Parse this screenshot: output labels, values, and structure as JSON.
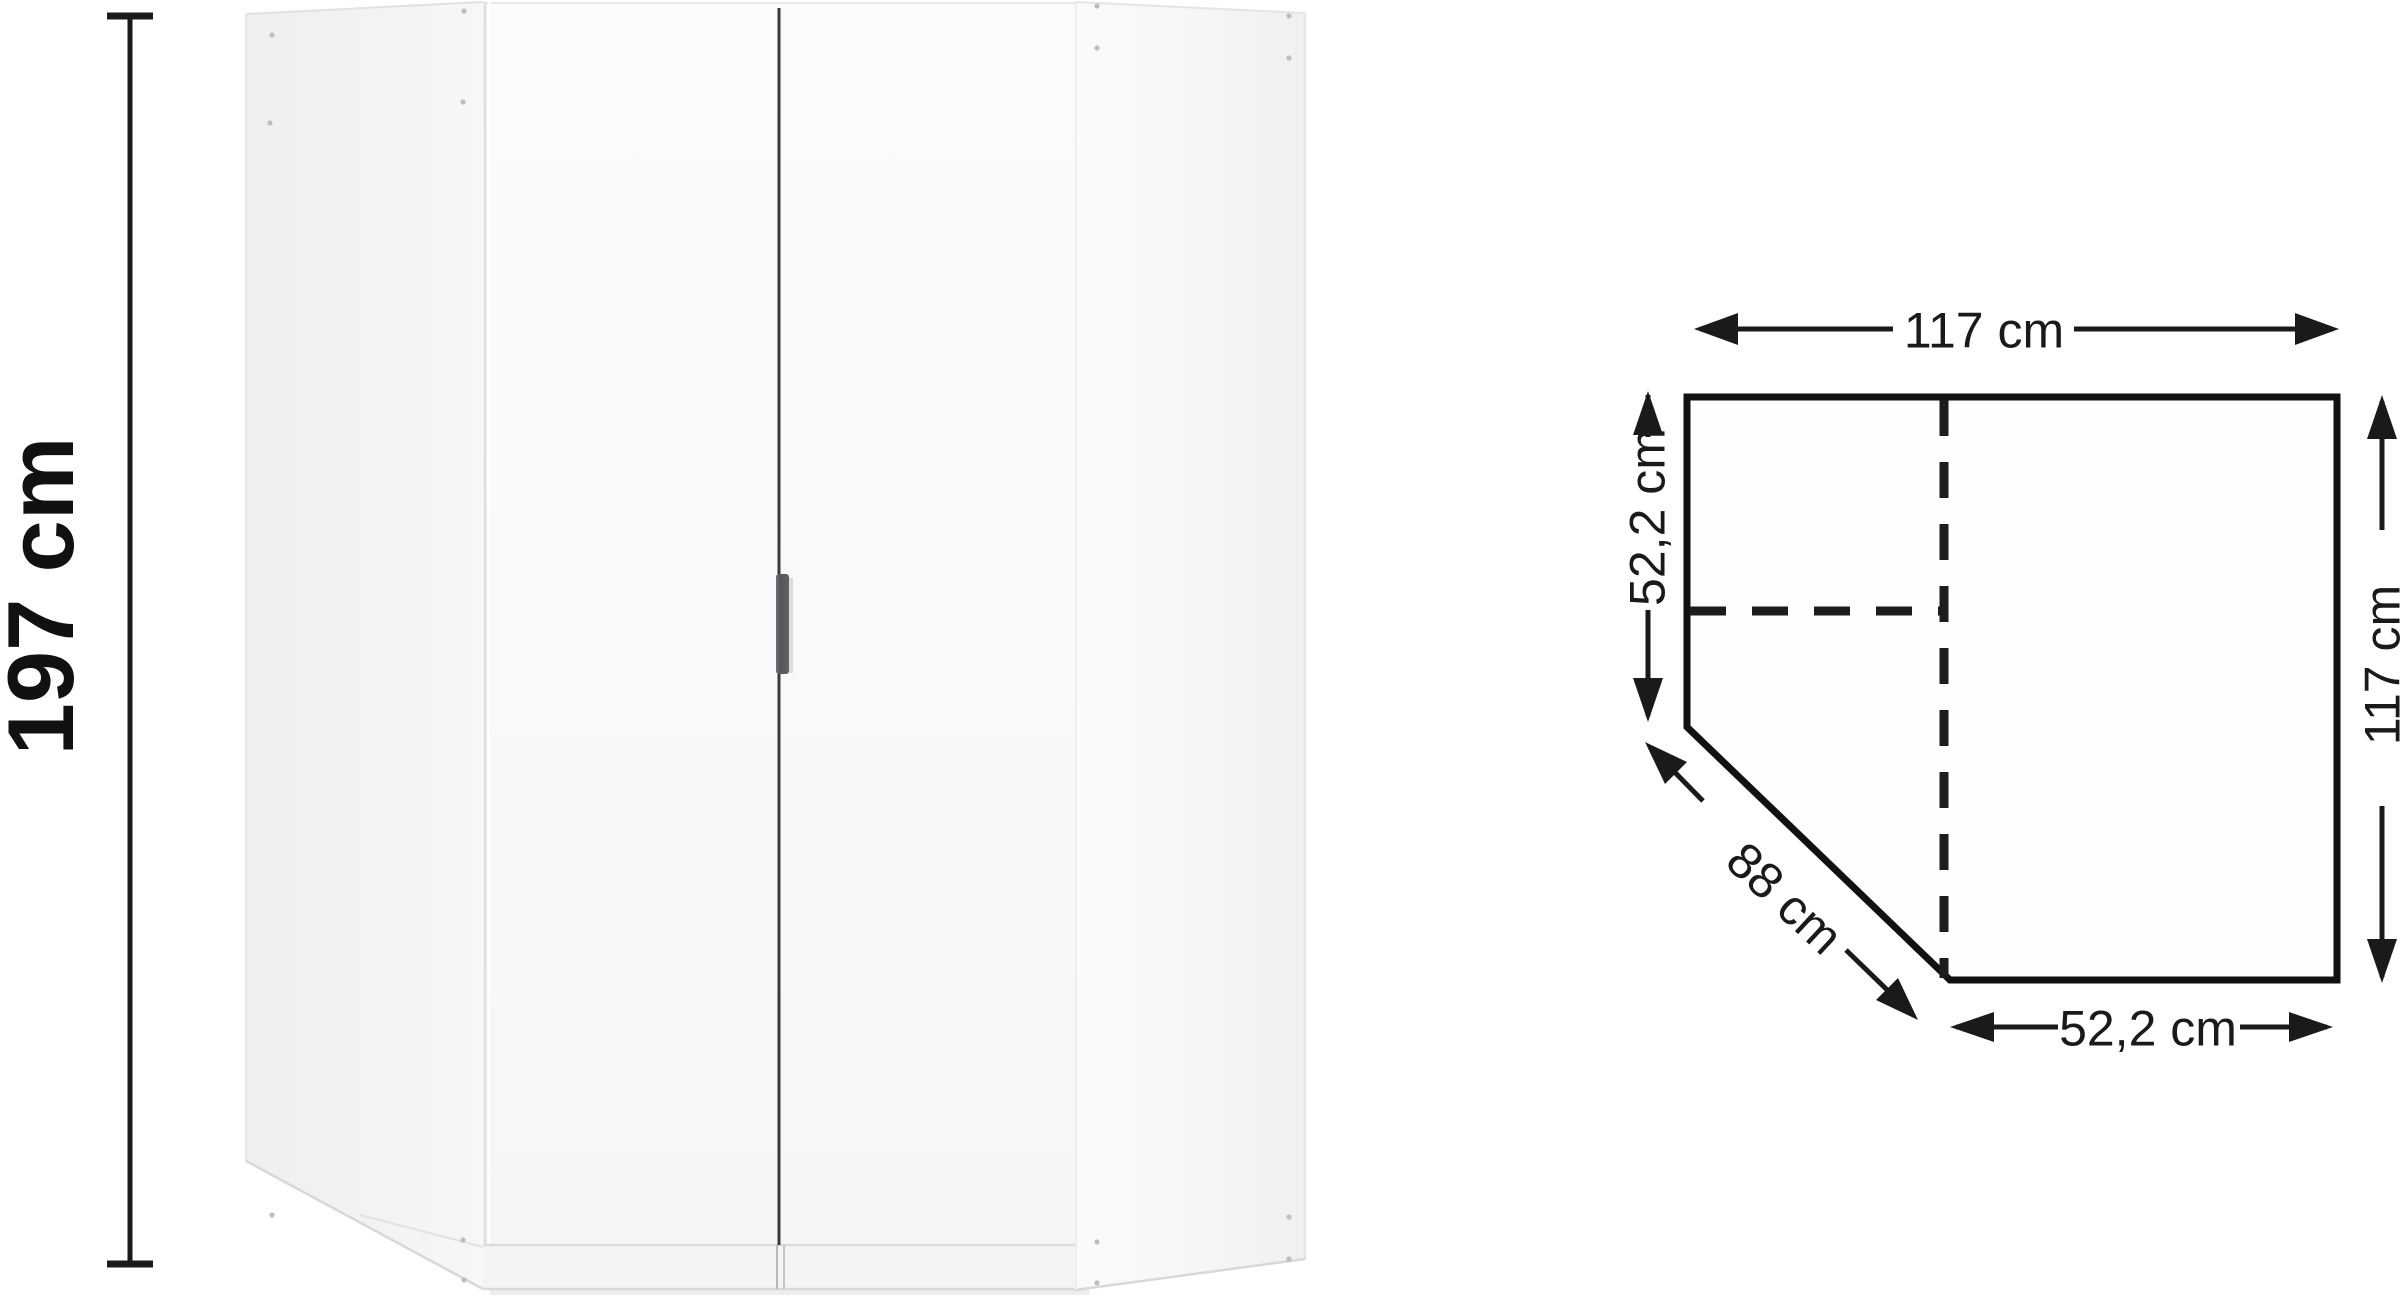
{
  "page": {
    "background": "#ffffff",
    "ink_color": "#1a1a1a",
    "wardrobe_panel_shade": "#eff0f2",
    "handle_color": "#565a5e"
  },
  "product_view": {
    "item": "corner-wardrobe-front-view",
    "height_dimension": {
      "label": "197 cm"
    }
  },
  "floor_plan": {
    "top_width": {
      "label": "117 cm"
    },
    "left_depth": {
      "label": "52,2 cm"
    },
    "right_width": {
      "label": "117 cm"
    },
    "diagonal_front": {
      "label": "88 cm"
    },
    "bottom_width": {
      "label": "52,2 cm"
    }
  }
}
